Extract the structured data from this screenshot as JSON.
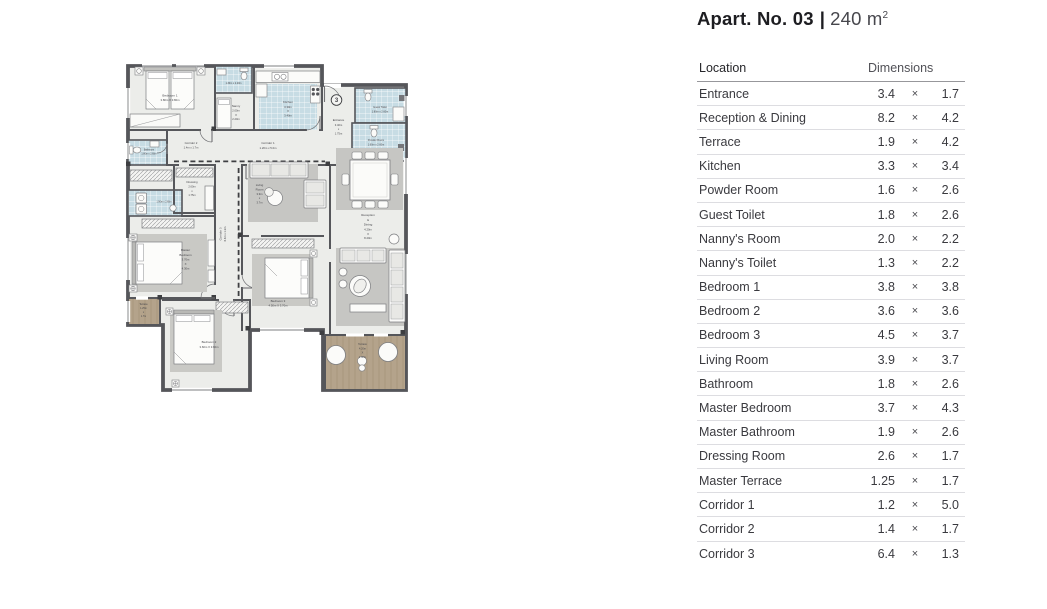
{
  "title": {
    "apartment": "Apart. No. 03",
    "separator": "|",
    "area_value": "240 m",
    "area_sup": "2"
  },
  "table": {
    "headers": {
      "location": "Location",
      "dimensions": "Dimensions"
    },
    "multiply_sign": "×",
    "rows": [
      {
        "location": "Entrance",
        "w": "3.4",
        "h": "1.7"
      },
      {
        "location": "Reception & Dining",
        "w": "8.2",
        "h": "4.2"
      },
      {
        "location": "Terrace",
        "w": "1.9",
        "h": "4.2"
      },
      {
        "location": "Kitchen",
        "w": "3.3",
        "h": "3.4"
      },
      {
        "location": "Powder Room",
        "w": "1.6",
        "h": "2.6"
      },
      {
        "location": "Guest Toilet",
        "w": "1.8",
        "h": "2.6"
      },
      {
        "location": "Nanny's Room",
        "w": "2.0",
        "h": "2.2"
      },
      {
        "location": "Nanny's Toilet",
        "w": "1.3",
        "h": "2.2"
      },
      {
        "location": "Bedroom 1",
        "w": "3.8",
        "h": "3.8"
      },
      {
        "location": "Bedroom 2",
        "w": "3.6",
        "h": "3.6"
      },
      {
        "location": "Bedroom 3",
        "w": "4.5",
        "h": "3.7"
      },
      {
        "location": "Living Room",
        "w": "3.9",
        "h": "3.7"
      },
      {
        "location": "Bathroom",
        "w": "1.8",
        "h": "2.6"
      },
      {
        "location": "Master Bedroom",
        "w": "3.7",
        "h": "4.3"
      },
      {
        "location": "Master Bathroom",
        "w": "1.9",
        "h": "2.6"
      },
      {
        "location": "Dressing Room",
        "w": "2.6",
        "h": "1.7"
      },
      {
        "location": "Master Terrace",
        "w": "1.25",
        "h": "1.7"
      },
      {
        "location": "Corridor 1",
        "w": "1.2",
        "h": "5.0"
      },
      {
        "location": "Corridor 2",
        "w": "1.4",
        "h": "1.7"
      },
      {
        "location": "Corridor 3",
        "w": "6.4",
        "h": "1.3"
      }
    ]
  },
  "plan": {
    "unit_number": "3",
    "colors": {
      "wall": "#55565a",
      "floor": "#ecedea",
      "tile_blue": "#c7dce4",
      "terrace_tan": "#b4a38b",
      "rug_gray": "#c9c9c5"
    },
    "labels": {
      "bedroom1": [
        "Bedroom 1",
        "3.80m X 3.80m"
      ],
      "nanny_toilet": [
        "1.30m x 2.20m"
      ],
      "nanny": [
        "Nanny",
        "2.00m",
        "X",
        "2.20m"
      ],
      "kitchen": [
        "Kitchen",
        "3.30m",
        "X",
        "3.40m"
      ],
      "entrance": [
        "Entrance",
        "3.40m",
        "x",
        "1.75m"
      ],
      "guest_toilet": [
        "Guest Toilet",
        "1.80m x 2.60m"
      ],
      "powder_room": [
        "Powder Room",
        "1.60m x 2.60m"
      ],
      "corridor1": [
        "Corridor 1",
        "1.20m x 5.0m"
      ],
      "corridor2": [
        "Corridor 2",
        "1.4m x 1.7m"
      ],
      "corridor3": [
        "Corridor 3",
        "6.4m x 1.3m"
      ],
      "bathroom": [
        "Bathroom",
        "1.80m x 2.60m"
      ],
      "dressing": [
        "Dressing",
        "2.60m",
        "x",
        "1.75m"
      ],
      "master_bathroom": [
        "1.90m x 2.60m"
      ],
      "master_bedroom": [
        "Master",
        "Bedroom",
        "3.70m",
        "X",
        "4.30m"
      ],
      "master_terrace": [
        "Terrace",
        "1.25m",
        "x",
        "1.7m"
      ],
      "bedroom2": [
        "Bedroom 2",
        "3.60m X 3.60m"
      ],
      "bedroom3": [
        "Bedroom 3",
        "4.50m X 3.70m"
      ],
      "living_room": [
        "Living",
        "Room",
        "3.9m",
        "x",
        "3.7m"
      ],
      "reception": [
        "Reception",
        "&",
        "Dining",
        "4.20m",
        "X",
        "8.20m"
      ],
      "terrace_main": [
        "Terrace",
        "4.20m",
        "X",
        "1.90m"
      ]
    }
  }
}
